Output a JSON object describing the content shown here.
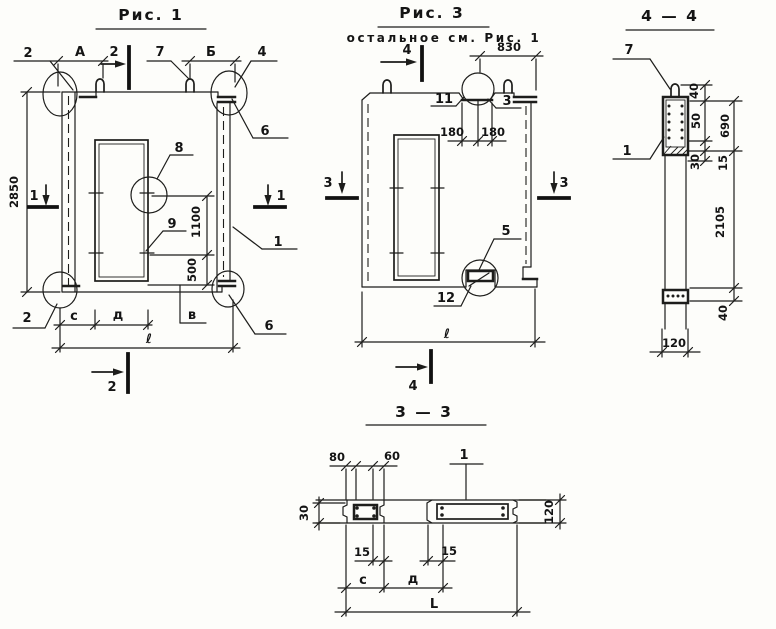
{
  "sheet_title": "Панель железобетонная — рабочие чертежи",
  "fig1": {
    "title": "Рис. 1",
    "det2_top": "2",
    "dim_a": "А",
    "sec2_top": "2",
    "det7": "7",
    "dim_b": "Б",
    "det4": "4",
    "dim_height": "2850",
    "sec1_left": "1",
    "sec1_right": "1",
    "det8": "8",
    "det9": "9",
    "dim_1100": "1100",
    "dim_500": "500",
    "det6_top": "6",
    "det1": "1",
    "det6_bot": "6",
    "det2_bot": "2",
    "dim_c": "с",
    "dim_d": "д",
    "dim_v": "в",
    "dim_len": "ℓ",
    "sec2_bot": "2"
  },
  "fig3": {
    "title": "Рис. 3",
    "subtitle": "остальное см. Рис. 1",
    "sec4_top": "4",
    "dim_830": "830",
    "det11": "11",
    "det3": "3",
    "dim_180l": "180",
    "dim_180r": "180",
    "sec3_left": "3",
    "sec3_right": "3",
    "det5": "5",
    "det12": "12",
    "dim_len": "ℓ",
    "sec4_bot": "4"
  },
  "sec44": {
    "title": "4 — 4",
    "det7": "7",
    "det1": "1",
    "dim_40t": "40",
    "dim_50": "50",
    "dim_690": "690",
    "dim_30": "30",
    "dim_15": "15",
    "dim_2105": "2105",
    "dim_40b": "40",
    "dim_120": "120"
  },
  "sec33": {
    "title": "3 — 3",
    "dim_80": "80",
    "dim_60": "60",
    "det1": "1",
    "dim_30": "30",
    "dim_120": "120",
    "dim_15l": "15",
    "dim_15r": "15",
    "dim_c": "с",
    "dim_d": "д",
    "dim_len": "L"
  }
}
